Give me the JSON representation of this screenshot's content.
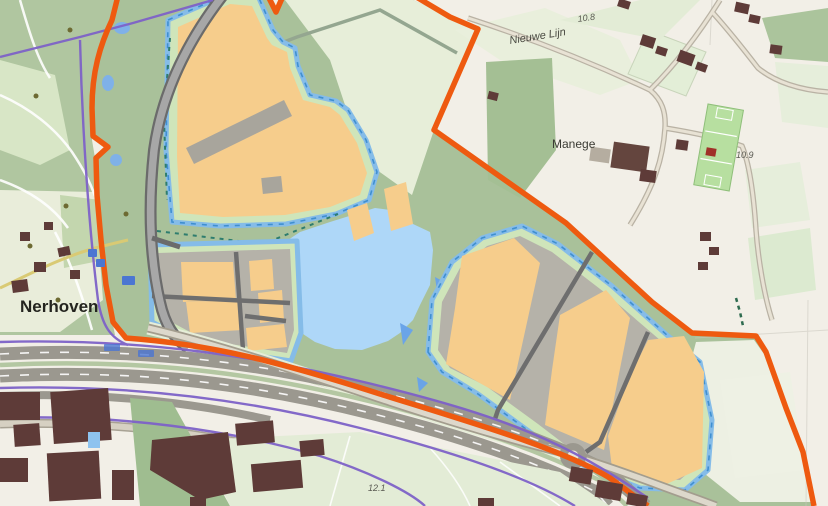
{
  "map": {
    "type": "topographic-development-plan",
    "labels": {
      "settlement": "Nerhoven",
      "street": "Nieuwe Lijn",
      "poi": "Manege",
      "spot_height_top": "10.8",
      "spot_height_right": "10.9",
      "spot_height_bottom": "12.1"
    },
    "colors": {
      "plan_boundary": "#EE5A10",
      "development_plot": "#F6CD8C",
      "water": "#AED7F8",
      "field_green": "#A9C19A",
      "pale_field": "#E7EED9",
      "background": "#F2EFE7",
      "built_parcel_gray": "#B5B2A9",
      "building_dark": "#5E3B38",
      "pipeline_purple": "#7E62C8",
      "ditch_blue": "#85BCE8",
      "buffer_green": "#CFE5BA",
      "road_dark": "#6E6E6E"
    },
    "features": {
      "boundary": "orange plan boundary line",
      "lake": "retention pond",
      "plots": "industrial development plots",
      "highway": "motorway with pipelines",
      "roundabout": "roundabout"
    }
  }
}
